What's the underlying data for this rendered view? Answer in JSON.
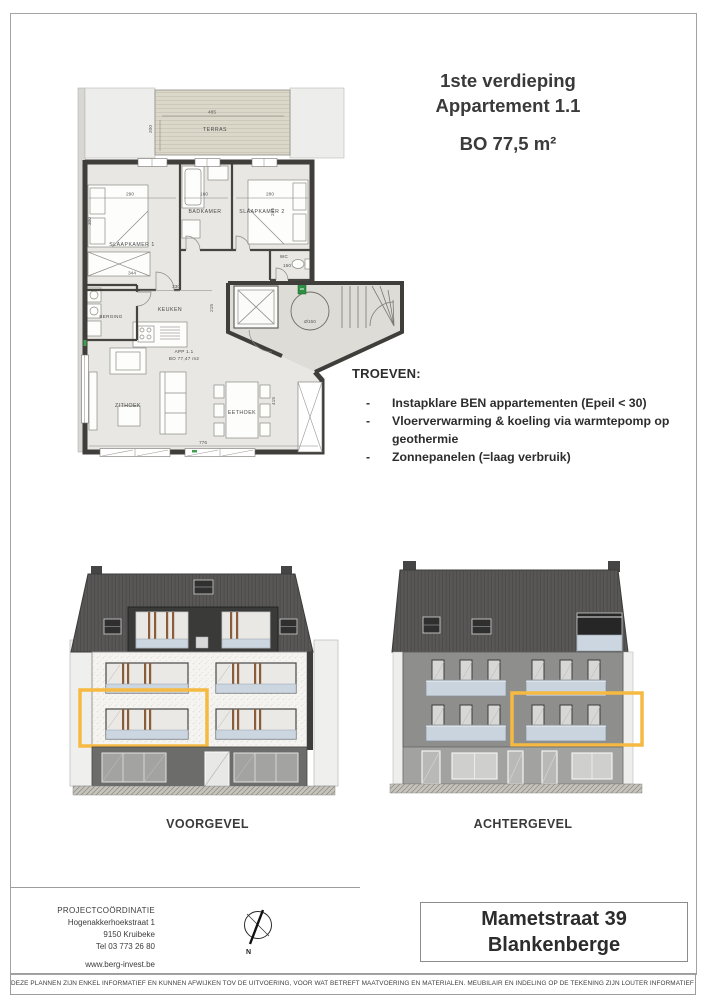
{
  "title_block": {
    "floor": "1ste verdieping",
    "apartment": "Appartement 1.1",
    "area": "BO 77,5 m²"
  },
  "plan": {
    "rooms": {
      "terras": "TERRAS",
      "slaapkamer1": "SLAAPKAMER 1",
      "badkamer": "BADKAMER",
      "slaapkamer2": "SLAAPKAMER 2",
      "wc": "WC",
      "keuken": "KEUKEN",
      "berging": "BERGING",
      "zithoek": "ZITHOEK",
      "eethoek": "EETHOEK"
    },
    "app_label_line1": "APP 1.1",
    "app_label_line2": "BO 77,47 m2",
    "dims": {
      "terras_w": "485",
      "terras_d": "200",
      "slaapkamer1_w": "290",
      "slaapkamer1_d": "300",
      "slaapkamer1_closet": "344",
      "badkamer_w": "160",
      "slaapkamer2_w": "280",
      "slaapkamer2_d": "245",
      "wc_w": "150",
      "keuken_w": "330",
      "keuken_d": "215",
      "living_w": "776",
      "living_d": "415",
      "shaft": "Ø150"
    }
  },
  "troeven": {
    "heading": "TROEVEN:",
    "bullet": "-",
    "items": [
      "Instapklare BEN appartementen (Epeil < 30)",
      "Vloerverwarming & koeling via warmtepomp op geothermie",
      "Zonnepanelen (=laag verbruik)"
    ]
  },
  "elevations": {
    "front_label": "VOORGEVEL",
    "back_label": "ACHTERGEVEL"
  },
  "footer": {
    "coordination_title": "PROJECTCOÖRDINATIE",
    "street": "Hogenakkerhoekstraat 1",
    "city": "9150 Kruibeke",
    "phone": "Tel 03 773 26 80",
    "website": "www.berg-invest.be",
    "compass_north": "N",
    "project_street": "Mametstraat 39",
    "project_city": "Blankenberge",
    "disclaimer": "DEZE PLANNEN ZIJN ENKEL INFORMATIEF EN KUNNEN AFWIJKEN TOV DE UITVOERING, VOOR WAT BETREFT MAATVOERING EN MATERIALEN. MEUBILAIR EN INDELING OP DE TEKENING ZIJN LOUTER INFORMATIEF EN NIET BINDEND."
  },
  "colors": {
    "highlight": "#F6BA43",
    "wall": "#3F3E3B",
    "glass_panel": "#CCD6E0"
  }
}
